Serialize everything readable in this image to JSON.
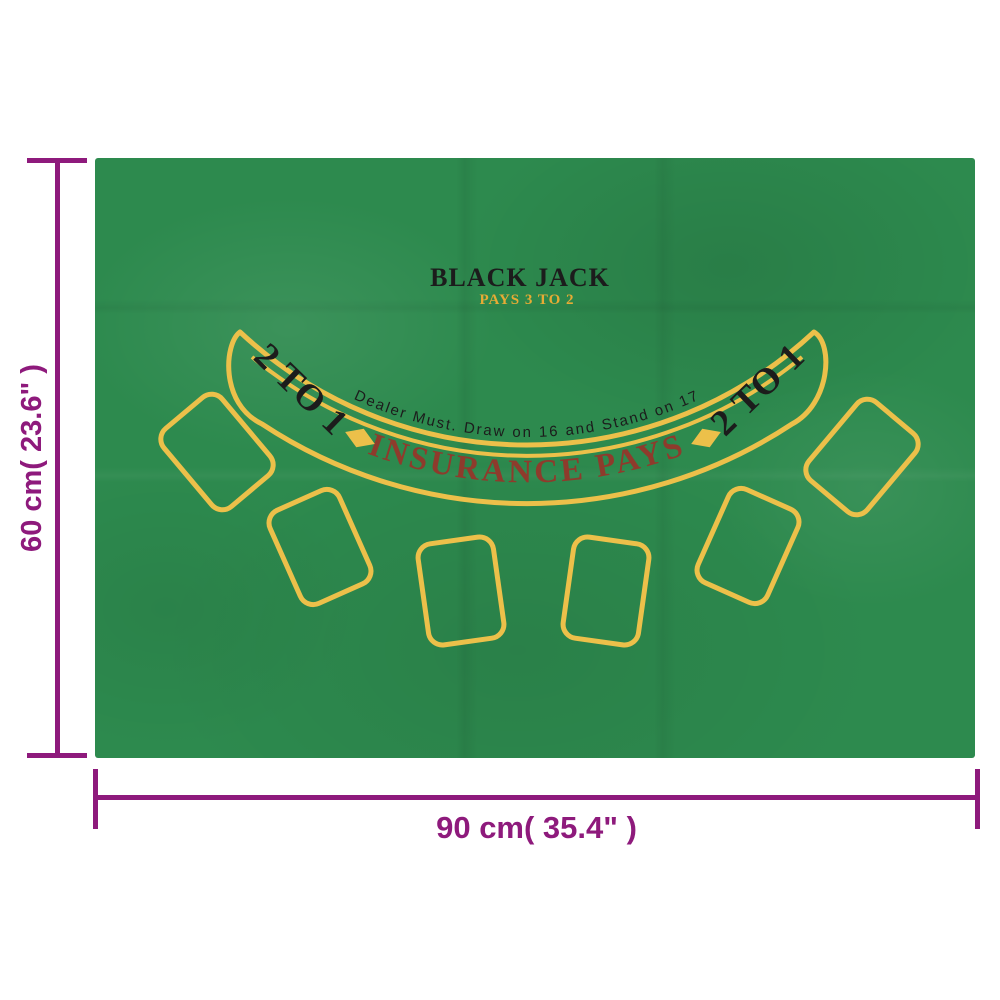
{
  "product": {
    "title": "BLACK JACK",
    "subtitle": "PAYS 3 TO 2",
    "dealer_rule": "Dealer Must. Draw on 16 and Stand on 17",
    "insurance_text": "INSURANCE PAYS",
    "odds_left": "2 TO 1",
    "odds_right": "2 TO 1",
    "card_spots_count": 6
  },
  "dimensions": {
    "height_label": "60 cm( 23.6\" )",
    "width_label": "90 cm( 35.4\" )"
  },
  "colors": {
    "background_white": "#ffffff",
    "felt_green": "#2d8a4e",
    "marking_yellow": "#ecc04a",
    "subtitle_gold": "#e7ab35",
    "insurance_maroon": "#8e3b2c",
    "print_black": "#1c1c1c",
    "dimension_purple": "#8e1a7c"
  }
}
